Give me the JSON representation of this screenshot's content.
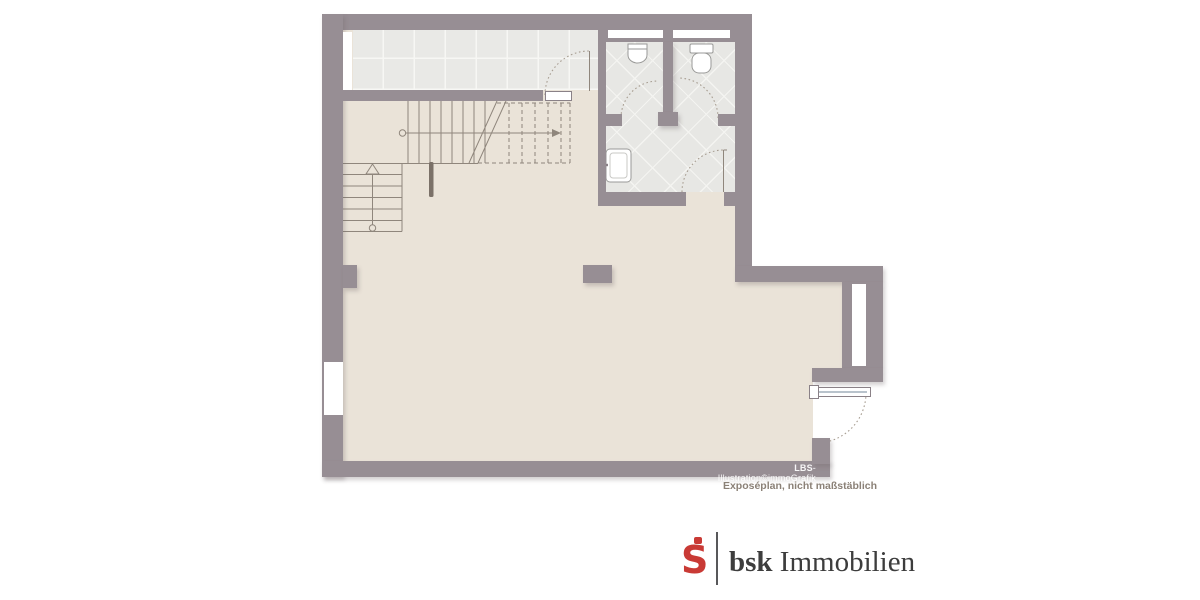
{
  "css_vars": {
    "wall": "#978e94",
    "floor": "#eae3d8",
    "ctile": "#e9e9e6",
    "btile": "#e7e7e4",
    "line": "#8f867c",
    "arc": "#a79d91",
    "wframe": "#b9c3cc",
    "brand-red": "#c93a35",
    "brand-text": "#3d3d3d",
    "divider": "#58585a"
  },
  "floor_plan": {
    "credit_bold": "LBS",
    "credit_rest": "-Illustration©immoGrafik",
    "disclaimer": "Exposéplan, nicht maßstäblich"
  },
  "branding": {
    "symbol": "sparkasse-s-icon",
    "symbol_letter": "S",
    "name_bold": "bsk",
    "name_rest": " Immobilien"
  }
}
